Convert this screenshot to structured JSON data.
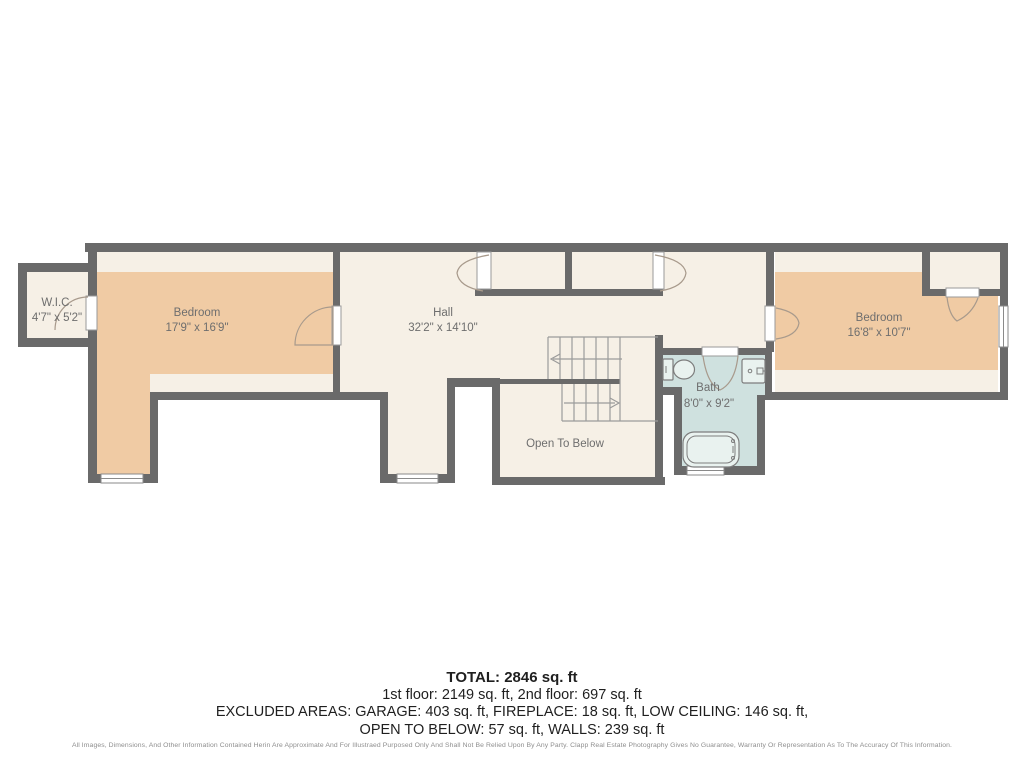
{
  "rooms": {
    "wic": {
      "label": "W.I.C.",
      "dims": "4'7\" x 5'2\""
    },
    "bedroom_left": {
      "label": "Bedroom",
      "dims": "17'9\" x 16'9\""
    },
    "hall": {
      "label": "Hall",
      "dims": "32'2\" x 14'10\""
    },
    "open_to_below": {
      "label": "Open To Below"
    },
    "bath": {
      "label": "Bath",
      "dims": "8'0\" x 9'2\""
    },
    "bedroom_right": {
      "label": "Bedroom",
      "dims": "16'8\" x 10'7\""
    }
  },
  "summary": {
    "total": "TOTAL: 2846 sq. ft",
    "floors": "1st floor: 2149 sq. ft, 2nd floor: 697 sq. ft",
    "excluded_line1": "EXCLUDED AREAS: GARAGE: 403 sq. ft, FIREPLACE: 18 sq. ft, LOW CEILING: 146 sq. ft,",
    "excluded_line2": "OPEN TO BELOW: 57 sq. ft, WALLS: 239 sq. ft",
    "disclaimer": "All Images, Dimensions, And Other Information Contained Herin Are Approximate And For Illustraed Purposed Only And Shall Not Be Relied Upon By Any Party. Clapp Real Estate Photography Gives No Guarantee, Warranty Or Representation As To The Accuracy Of This Information."
  },
  "colors": {
    "wall": "#6a6a6a",
    "floor": "#f6f0e6",
    "tan": "#f0cba4",
    "bath": "#cfe1df",
    "label": "#6e6e6e",
    "ink": "#1f1f1f",
    "fine": "#8e8e8e"
  }
}
